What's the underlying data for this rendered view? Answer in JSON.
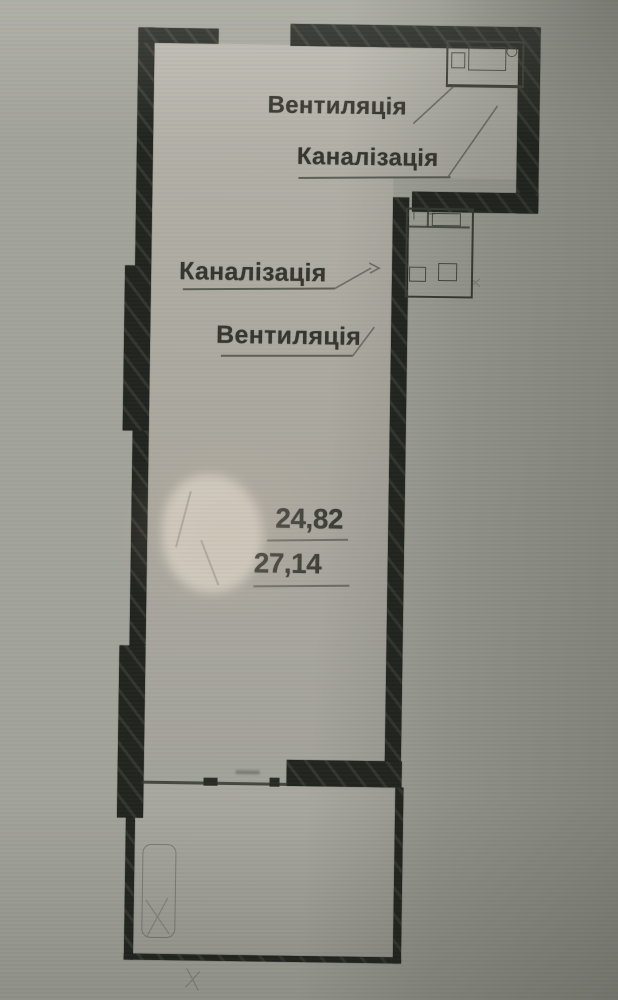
{
  "plan": {
    "annotations": {
      "ventilation_top": "Вентиляція",
      "sewerage_top": "Каналізація",
      "sewerage_middle": "Каналізація",
      "ventilation_middle": "Вентиляція"
    },
    "areas": {
      "upper_value": "24,82",
      "lower_value": "27,14"
    },
    "colors": {
      "paper_outside": "#a2a39a",
      "paper_inside": "#b2b0a7",
      "wall_ink": "#22241f",
      "thin_line": "#3a3d36",
      "text_ink": "#35372f"
    }
  }
}
